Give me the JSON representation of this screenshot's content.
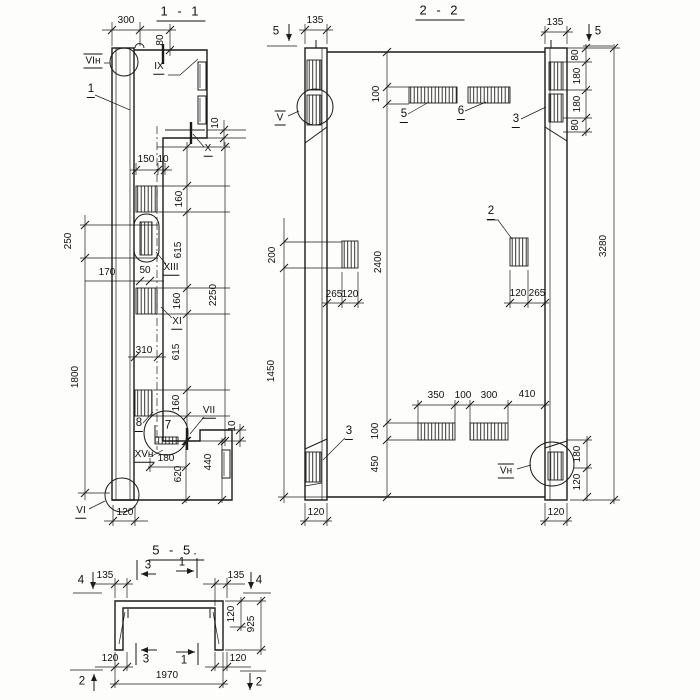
{
  "section_1_1": {
    "title": "1 - 1",
    "dims": {
      "d300": "300",
      "d80": "80",
      "d10_step": "10",
      "d150": "150",
      "d10_w": "10",
      "d160_a": "160",
      "d615_a": "615",
      "d160_b": "160",
      "d615_b": "615",
      "d160_c": "160",
      "d2250": "2250",
      "d250": "250",
      "d170": "170",
      "d50": "50",
      "d1800": "1800",
      "d310": "310",
      "d180": "180",
      "d620": "620",
      "d440": "440",
      "d10_b": "10",
      "d120": "120"
    },
    "labels": {
      "vi_n": "VIн",
      "n1": "1",
      "ix": "IX",
      "x": "X",
      "xiii": "XIII",
      "xi": "XI",
      "n8": "8",
      "n7": "7",
      "vii": "VII",
      "xv_n": "XVн",
      "vi": "VI"
    }
  },
  "section_2_2": {
    "title": "2 - 2",
    "dims": {
      "d135_l": "135",
      "d135_r": "135",
      "d80_a": "80",
      "d180_a": "180",
      "d180_b": "180",
      "d80_b": "80",
      "d100_t": "100",
      "d2400": "2400",
      "d3280": "3280",
      "d200": "200",
      "d1450": "1450",
      "d265_l": "265",
      "d120_l": "120",
      "d120_r": "120",
      "d265_r": "265",
      "d350": "350",
      "d100_m": "100",
      "d300": "300",
      "d410": "410",
      "d100_b": "100",
      "d450": "450",
      "d180_br": "180",
      "d120_br": "120",
      "d120_cl": "120",
      "d120_cr": "120"
    },
    "labels": {
      "mk5_l": "5",
      "mk5_r": "5",
      "v": "V",
      "n5": "5",
      "n6": "6",
      "n3_t": "3",
      "n2": "2",
      "n3_b": "3",
      "v_n": "Vн"
    }
  },
  "section_5_5": {
    "title": "5 - 5.",
    "dims": {
      "d135_l": "135",
      "d135_r": "135",
      "d120_t": "120",
      "d925": "925",
      "d120_bl": "120",
      "d120_br": "120",
      "d1970": "1970"
    },
    "labels": {
      "mk4_l": "4",
      "mk4_r": "4",
      "mk3_t": "3",
      "mk1_t": "1",
      "mk3_b": "3",
      "mk1_b": "1",
      "mk2_l": "2",
      "mk2_r": "2"
    }
  }
}
